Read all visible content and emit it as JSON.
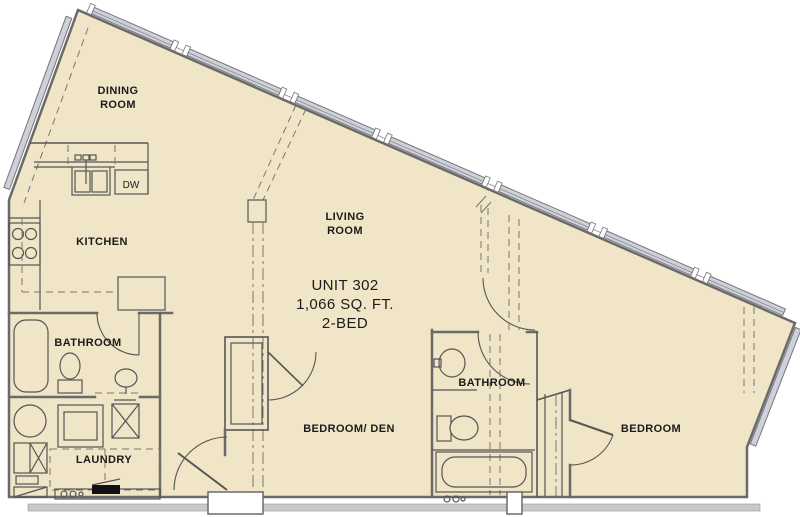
{
  "unit": {
    "title": "UNIT 302",
    "area": "1,066 SQ. FT.",
    "bedrooms": "2-BED"
  },
  "rooms": {
    "dining_room": {
      "line1": "DINING",
      "line2": "ROOM"
    },
    "kitchen": {
      "label": "KITCHEN"
    },
    "living_room": {
      "line1": "LIVING",
      "line2": "ROOM"
    },
    "bathroom_1": {
      "label": "BATHROOM"
    },
    "laundry": {
      "label": "LAUNDRY"
    },
    "bedroom_den": {
      "label": "BEDROOM/ DEN"
    },
    "bathroom_2": {
      "label": "BATHROOM"
    },
    "bedroom_2": {
      "label": "BEDROOM"
    }
  },
  "appliances": {
    "dishwasher_label": "DW"
  },
  "colors": {
    "floor": "#f0e5c6",
    "wall": "#6a6a6a",
    "line": "#555555",
    "thin": "#777777",
    "window": "#ced1da",
    "corridor": "#c9c9c9",
    "text": "#1b1b1b",
    "black": "#111111",
    "bg": "#ffffff"
  }
}
